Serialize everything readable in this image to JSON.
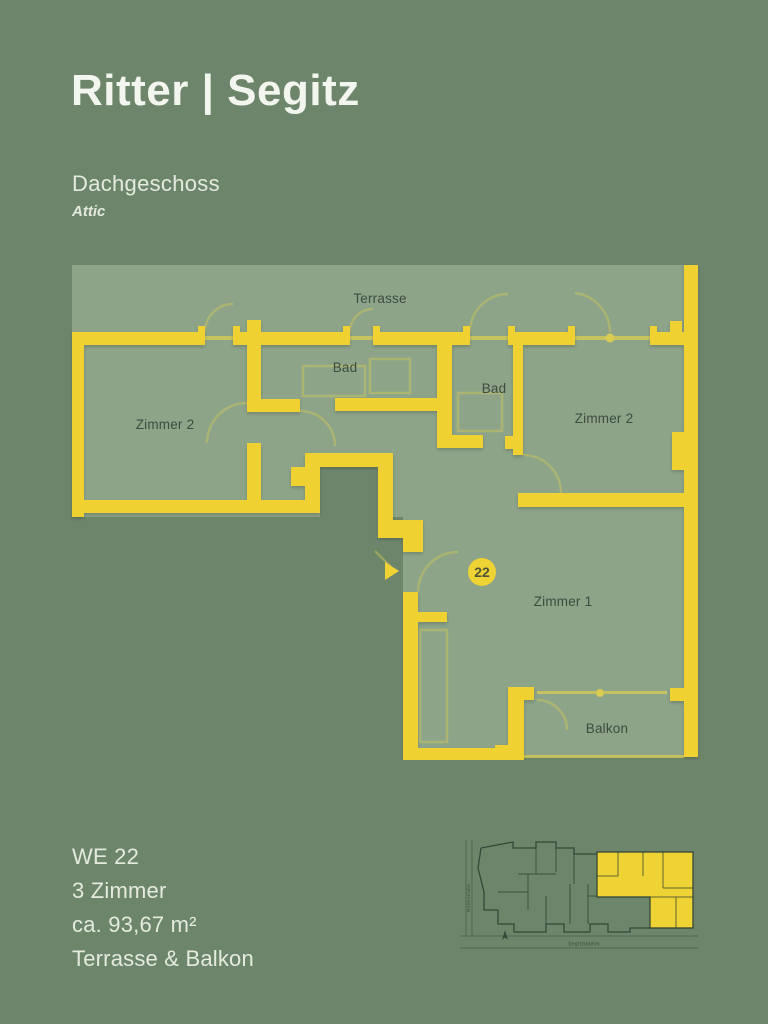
{
  "colors": {
    "background": "#6d866b",
    "plan_fill": "#8da489",
    "wall": "#efd233",
    "wall_faint": "#d9cc52",
    "text_light": "#e4eadd",
    "plan_label": "#3e4c40",
    "map_line": "#2c4233",
    "badge_text": "#4d5537"
  },
  "header": {
    "brand": "Ritter | Segitz",
    "floor_name": "Dachgeschoss",
    "floor_name_en": "Attic"
  },
  "floor_plan": {
    "unit_number": "22",
    "rooms": {
      "terrace": "Terrasse",
      "bath_1": "Bad",
      "bath_2": "Bad",
      "room_2_left": "Zimmer 2",
      "room_2_right": "Zimmer 2",
      "room_1": "Zimmer 1",
      "balcony": "Balkon"
    }
  },
  "site_map": {
    "street_left": "Ritterstraße",
    "street_bottom": "Segitzdamm"
  },
  "unit_info": {
    "unit_id": "WE 22",
    "room_count": "3 Zimmer",
    "area": "ca. 93,67 m²",
    "outdoor_features": "Terrasse & Balkon"
  }
}
